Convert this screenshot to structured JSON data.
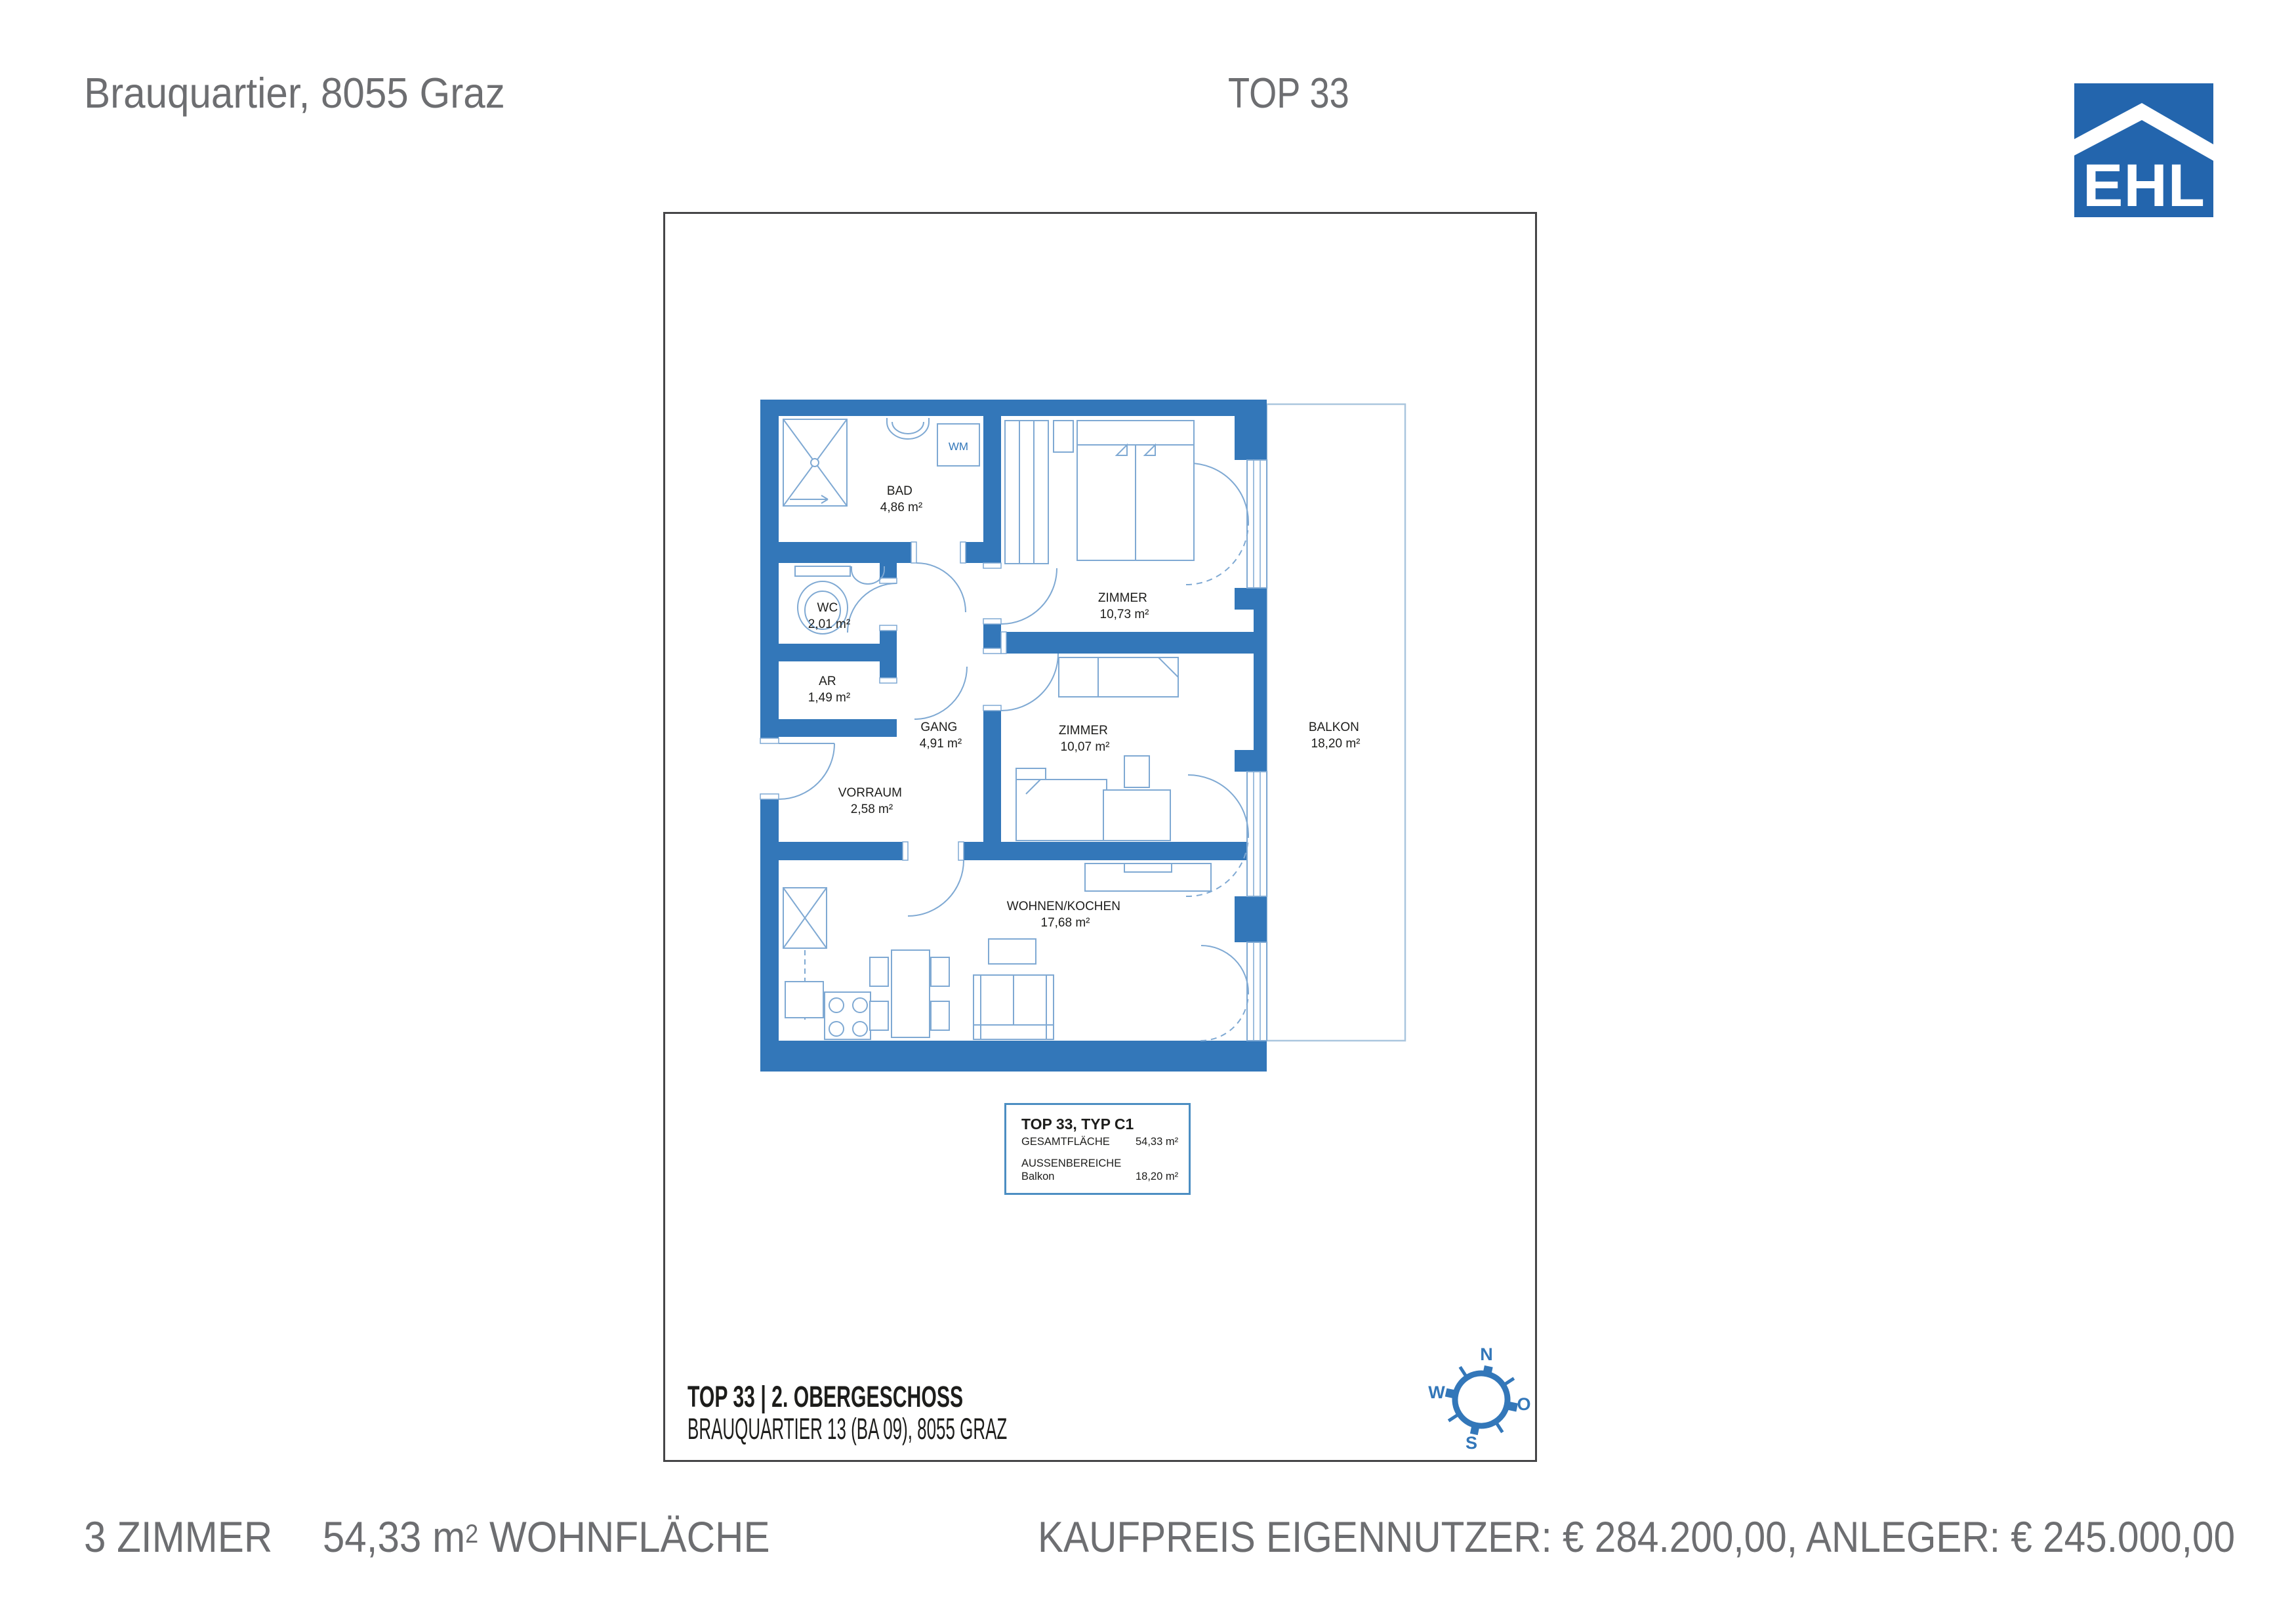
{
  "header": {
    "address": "Brauquartier, 8055 Graz",
    "unit": "TOP 33"
  },
  "logo": {
    "text": "EHL"
  },
  "plan": {
    "rooms": [
      {
        "name": "BAD",
        "area": "4,86 m²"
      },
      {
        "name": "WC",
        "area": "2,01 m²"
      },
      {
        "name": "AR",
        "area": "1,49 m²"
      },
      {
        "name": "GANG",
        "area": "4,91 m²"
      },
      {
        "name": "VORRAUM",
        "area": "2,58 m²"
      },
      {
        "name": "ZIMMER",
        "area": "10,73 m²"
      },
      {
        "name": "ZIMMER",
        "area": "10,07 m²"
      },
      {
        "name": "WOHNEN/KOCHEN",
        "area": "17,68 m²"
      },
      {
        "name": "BALKON",
        "area": "18,20 m²"
      }
    ],
    "appliance_label": "WM",
    "info_box": {
      "title": "TOP 33, TYP C1",
      "total_label": "GESAMTFLÄCHE",
      "total_value": "54,33 m²",
      "outdoor_label": "AUSSENBEREICHE",
      "balkon_label": "Balkon",
      "balkon_value": "18,20 m²"
    },
    "caption": {
      "line1": "TOP 33 | 2. OBERGESCHOSS",
      "line2": "BRAUQUARTIER 13 (BA 09), 8055 GRAZ"
    },
    "compass": {
      "n": "N",
      "e": "O",
      "s": "S",
      "w": "W"
    }
  },
  "footer": {
    "rooms": "3 ZIMMER",
    "area_value": "54,33",
    "area_unit": "m",
    "area_sup": "2",
    "area_label": "WOHNFLÄCHE",
    "price": "KAUFPREIS EIGENNUTZER: € 284.200,00, ANLEGER: € 245.000,00"
  },
  "colors": {
    "wall_blue": "#3377b9",
    "furniture_blue": "#7fa9d3",
    "balcony_blue": "#aac6de",
    "logo_blue": "#2365ad",
    "text_gray": "#6d6e71",
    "ink": "#1d1d1b"
  }
}
